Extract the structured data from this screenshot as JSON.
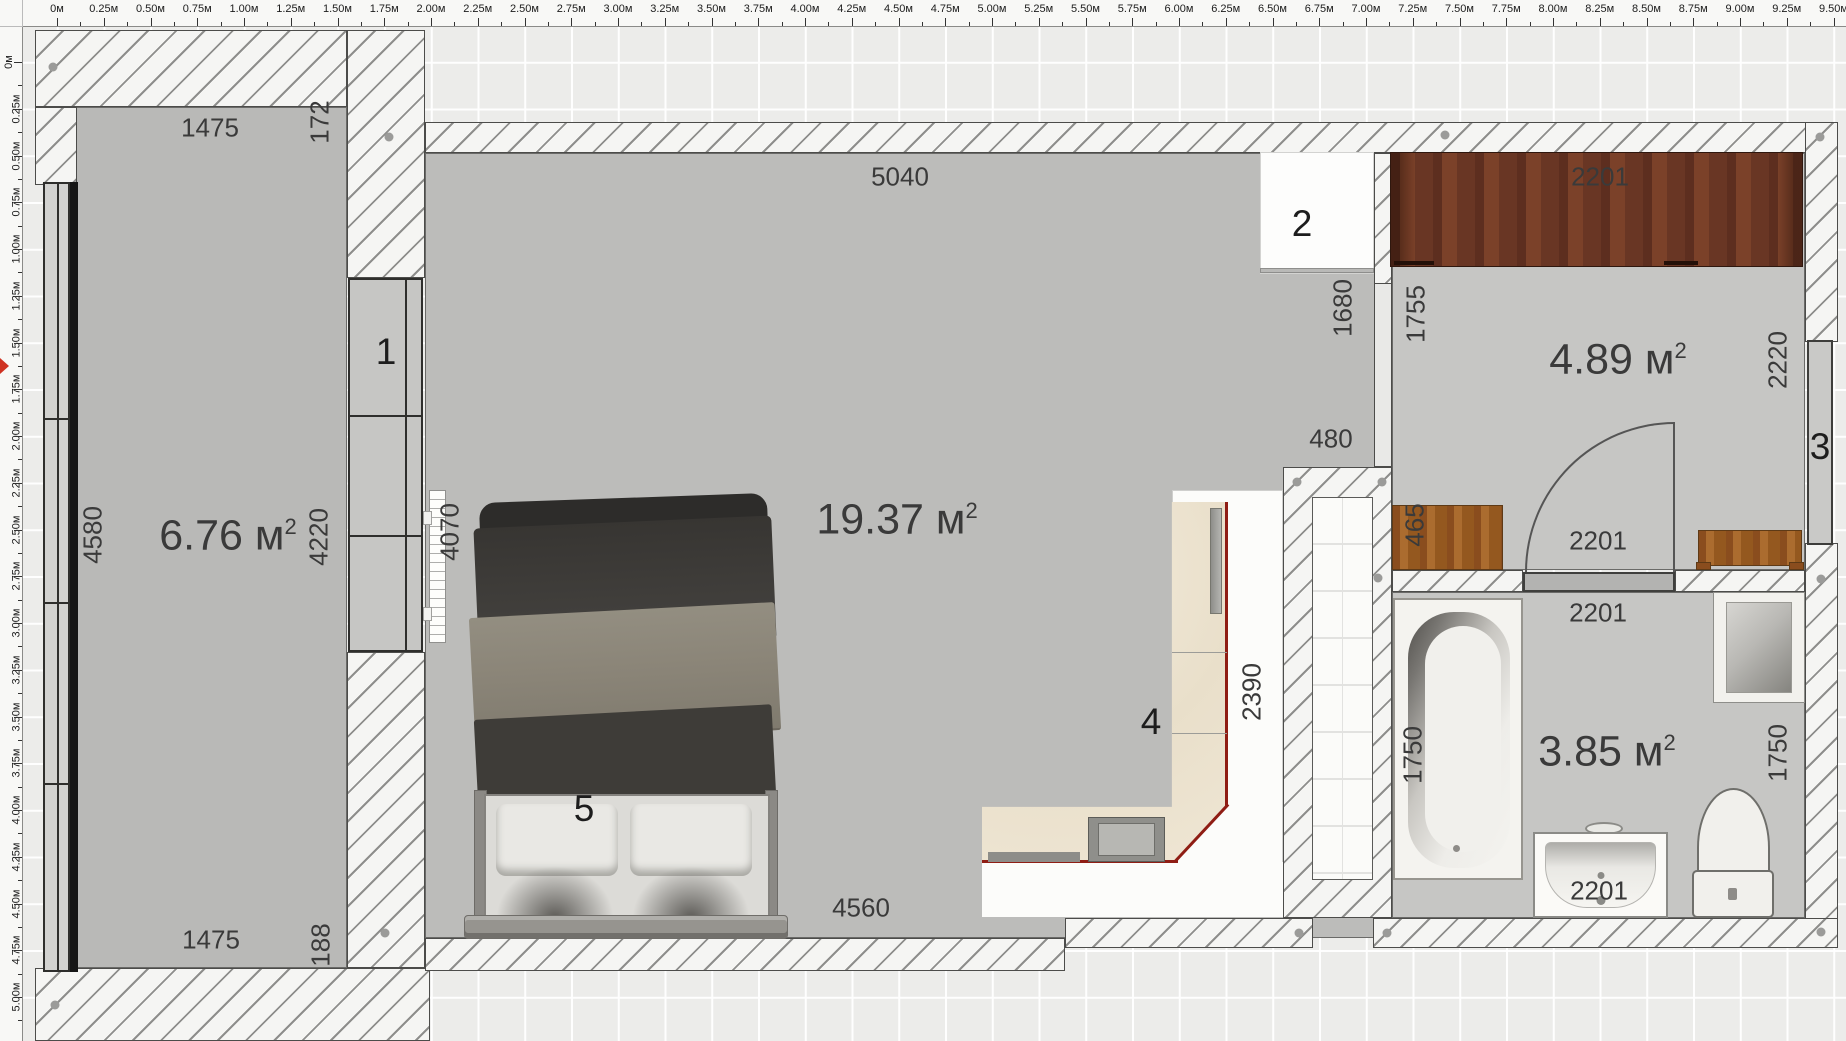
{
  "app": {
    "title": "floor-plan-editor",
    "unit_suffix": "м"
  },
  "colors": {
    "floor_gray": "#bcbcba",
    "wall_hatch_bg": "#f5f5f3",
    "accent_red": "#8f1d14",
    "cursor_red": "#cf3222",
    "wood_dark": "#6a3724",
    "wood_light": "#a96b2e",
    "counter_beige": "#e9dfca",
    "label_text": "#3a3a3a"
  },
  "rulers": {
    "top": {
      "origin_px": 57,
      "px_per_step": 46.75,
      "step_m": 0.25,
      "steps": 39,
      "zero_label": "0м"
    },
    "left": {
      "origin_px": 62,
      "px_per_step": 46.75,
      "step_m": 0.25,
      "steps": 21,
      "zero_label": "0м"
    }
  },
  "rooms": [
    {
      "name": "balcony",
      "area": "6.76",
      "unit": "м",
      "sup": "2",
      "cx": 228,
      "cy": 536
    },
    {
      "name": "living-room",
      "area": "19.37",
      "unit": "м",
      "sup": "2",
      "cx": 897,
      "cy": 520
    },
    {
      "name": "hallway",
      "area": "4.89",
      "unit": "м",
      "sup": "2",
      "cx": 1618,
      "cy": 360
    },
    {
      "name": "bathroom",
      "area": "3.85",
      "unit": "м",
      "sup": "2",
      "cx": 1607,
      "cy": 752
    }
  ],
  "dimensions": [
    {
      "text": "1475",
      "x": 210,
      "y": 128,
      "rot": false
    },
    {
      "text": "172",
      "x": 320,
      "y": 122,
      "rot": true
    },
    {
      "text": "5040",
      "x": 900,
      "y": 177,
      "rot": false
    },
    {
      "text": "2201",
      "x": 1600,
      "y": 177,
      "rot": false
    },
    {
      "text": "1680",
      "x": 1343,
      "y": 308,
      "rot": true
    },
    {
      "text": "1755",
      "x": 1416,
      "y": 314,
      "rot": true
    },
    {
      "text": "2220",
      "x": 1778,
      "y": 360,
      "rot": true
    },
    {
      "text": "480",
      "x": 1331,
      "y": 439,
      "rot": false
    },
    {
      "text": "465",
      "x": 1415,
      "y": 525,
      "rot": true
    },
    {
      "text": "2201",
      "x": 1598,
      "y": 541,
      "rot": false
    },
    {
      "text": "2201",
      "x": 1598,
      "y": 613,
      "rot": false
    },
    {
      "text": "4070",
      "x": 450,
      "y": 532,
      "rot": true
    },
    {
      "text": "4580",
      "x": 93,
      "y": 535,
      "rot": true
    },
    {
      "text": "4220",
      "x": 319,
      "y": 537,
      "rot": true
    },
    {
      "text": "2390",
      "x": 1252,
      "y": 692,
      "rot": true
    },
    {
      "text": "1750",
      "x": 1413,
      "y": 755,
      "rot": true
    },
    {
      "text": "1750",
      "x": 1778,
      "y": 753,
      "rot": true
    },
    {
      "text": "4560",
      "x": 861,
      "y": 908,
      "rot": false
    },
    {
      "text": "1475",
      "x": 211,
      "y": 940,
      "rot": false
    },
    {
      "text": "188",
      "x": 321,
      "y": 945,
      "rot": true
    },
    {
      "text": "2201",
      "x": 1599,
      "y": 891,
      "rot": false
    }
  ],
  "markers": [
    {
      "n": "1",
      "x": 386,
      "y": 352,
      "object": "balcony-window"
    },
    {
      "n": "2",
      "x": 1302,
      "y": 224,
      "object": "door-opening"
    },
    {
      "n": "3",
      "x": 1820,
      "y": 447,
      "object": "window"
    },
    {
      "n": "4",
      "x": 1151,
      "y": 722,
      "object": "kitchen-counter"
    },
    {
      "n": "5",
      "x": 584,
      "y": 809,
      "object": "bed"
    }
  ],
  "dots": [
    {
      "x": 53,
      "y": 67
    },
    {
      "x": 389,
      "y": 137
    },
    {
      "x": 1445,
      "y": 135
    },
    {
      "x": 1820,
      "y": 137
    },
    {
      "x": 1297,
      "y": 482
    },
    {
      "x": 1382,
      "y": 482
    },
    {
      "x": 1378,
      "y": 578
    },
    {
      "x": 1821,
      "y": 579
    },
    {
      "x": 55,
      "y": 1005
    },
    {
      "x": 385,
      "y": 933
    },
    {
      "x": 1299,
      "y": 933
    },
    {
      "x": 1387,
      "y": 933
    },
    {
      "x": 1821,
      "y": 932
    }
  ]
}
